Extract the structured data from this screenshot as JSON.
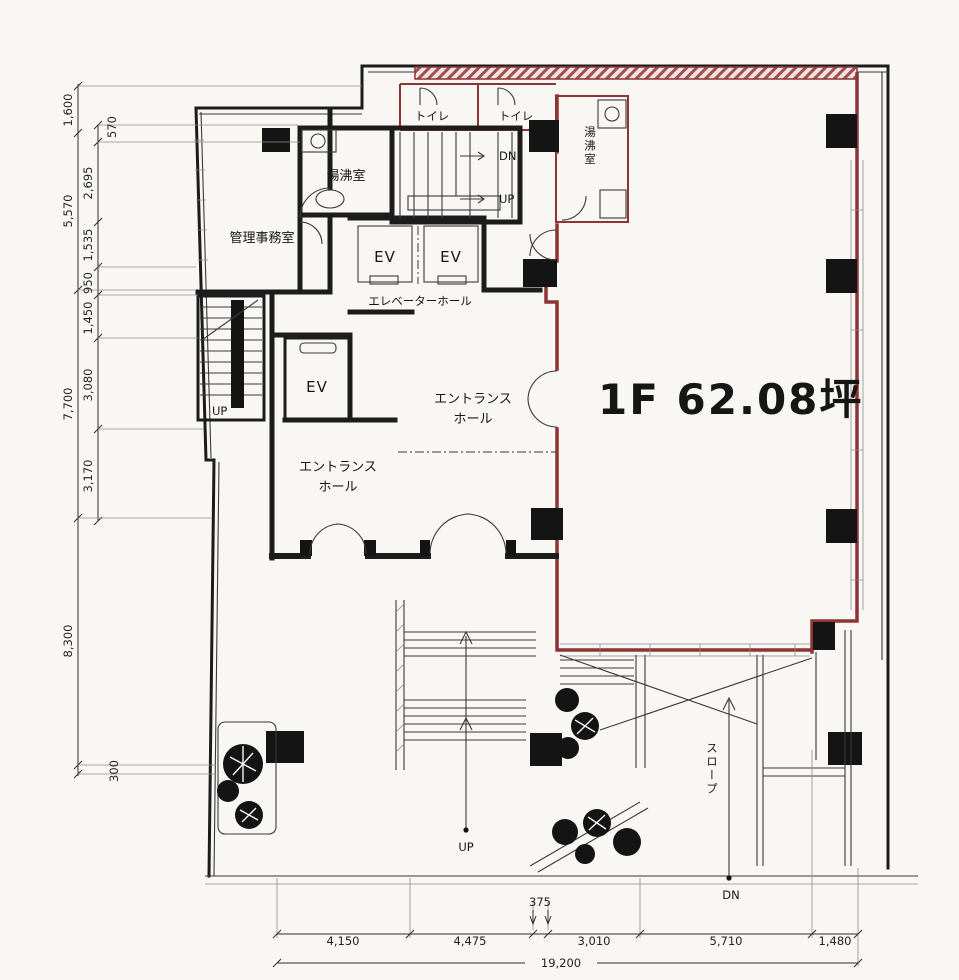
{
  "title": {
    "text": "1F 62.08坪"
  },
  "rooms": {
    "admin_office": "管理事務室",
    "kitchenette": "湯沸室",
    "toilet": "トイレ",
    "elevator_hall": "エレベーターホール",
    "ev": "EV",
    "entrance_line1": "エントランス",
    "entrance_line2": "ホール",
    "slope": "スロープ"
  },
  "marks": {
    "up": "UP",
    "dn": "DN"
  },
  "dimensions": {
    "left_outer": [
      "1,600",
      "5,570",
      "7,700",
      "8,300",
      "300"
    ],
    "left_inner": [
      "570",
      "2,695",
      "1,535",
      "950",
      "1,450",
      "3,080",
      "3,170"
    ],
    "bottom": [
      "4,150",
      "4,475",
      "375",
      "3,010",
      "5,710",
      "1,480"
    ],
    "bottom_total": "19,200"
  },
  "colors": {
    "boundary": "#8e3434",
    "ink": "#1c1c1c",
    "paper": "#f8f7f4"
  }
}
